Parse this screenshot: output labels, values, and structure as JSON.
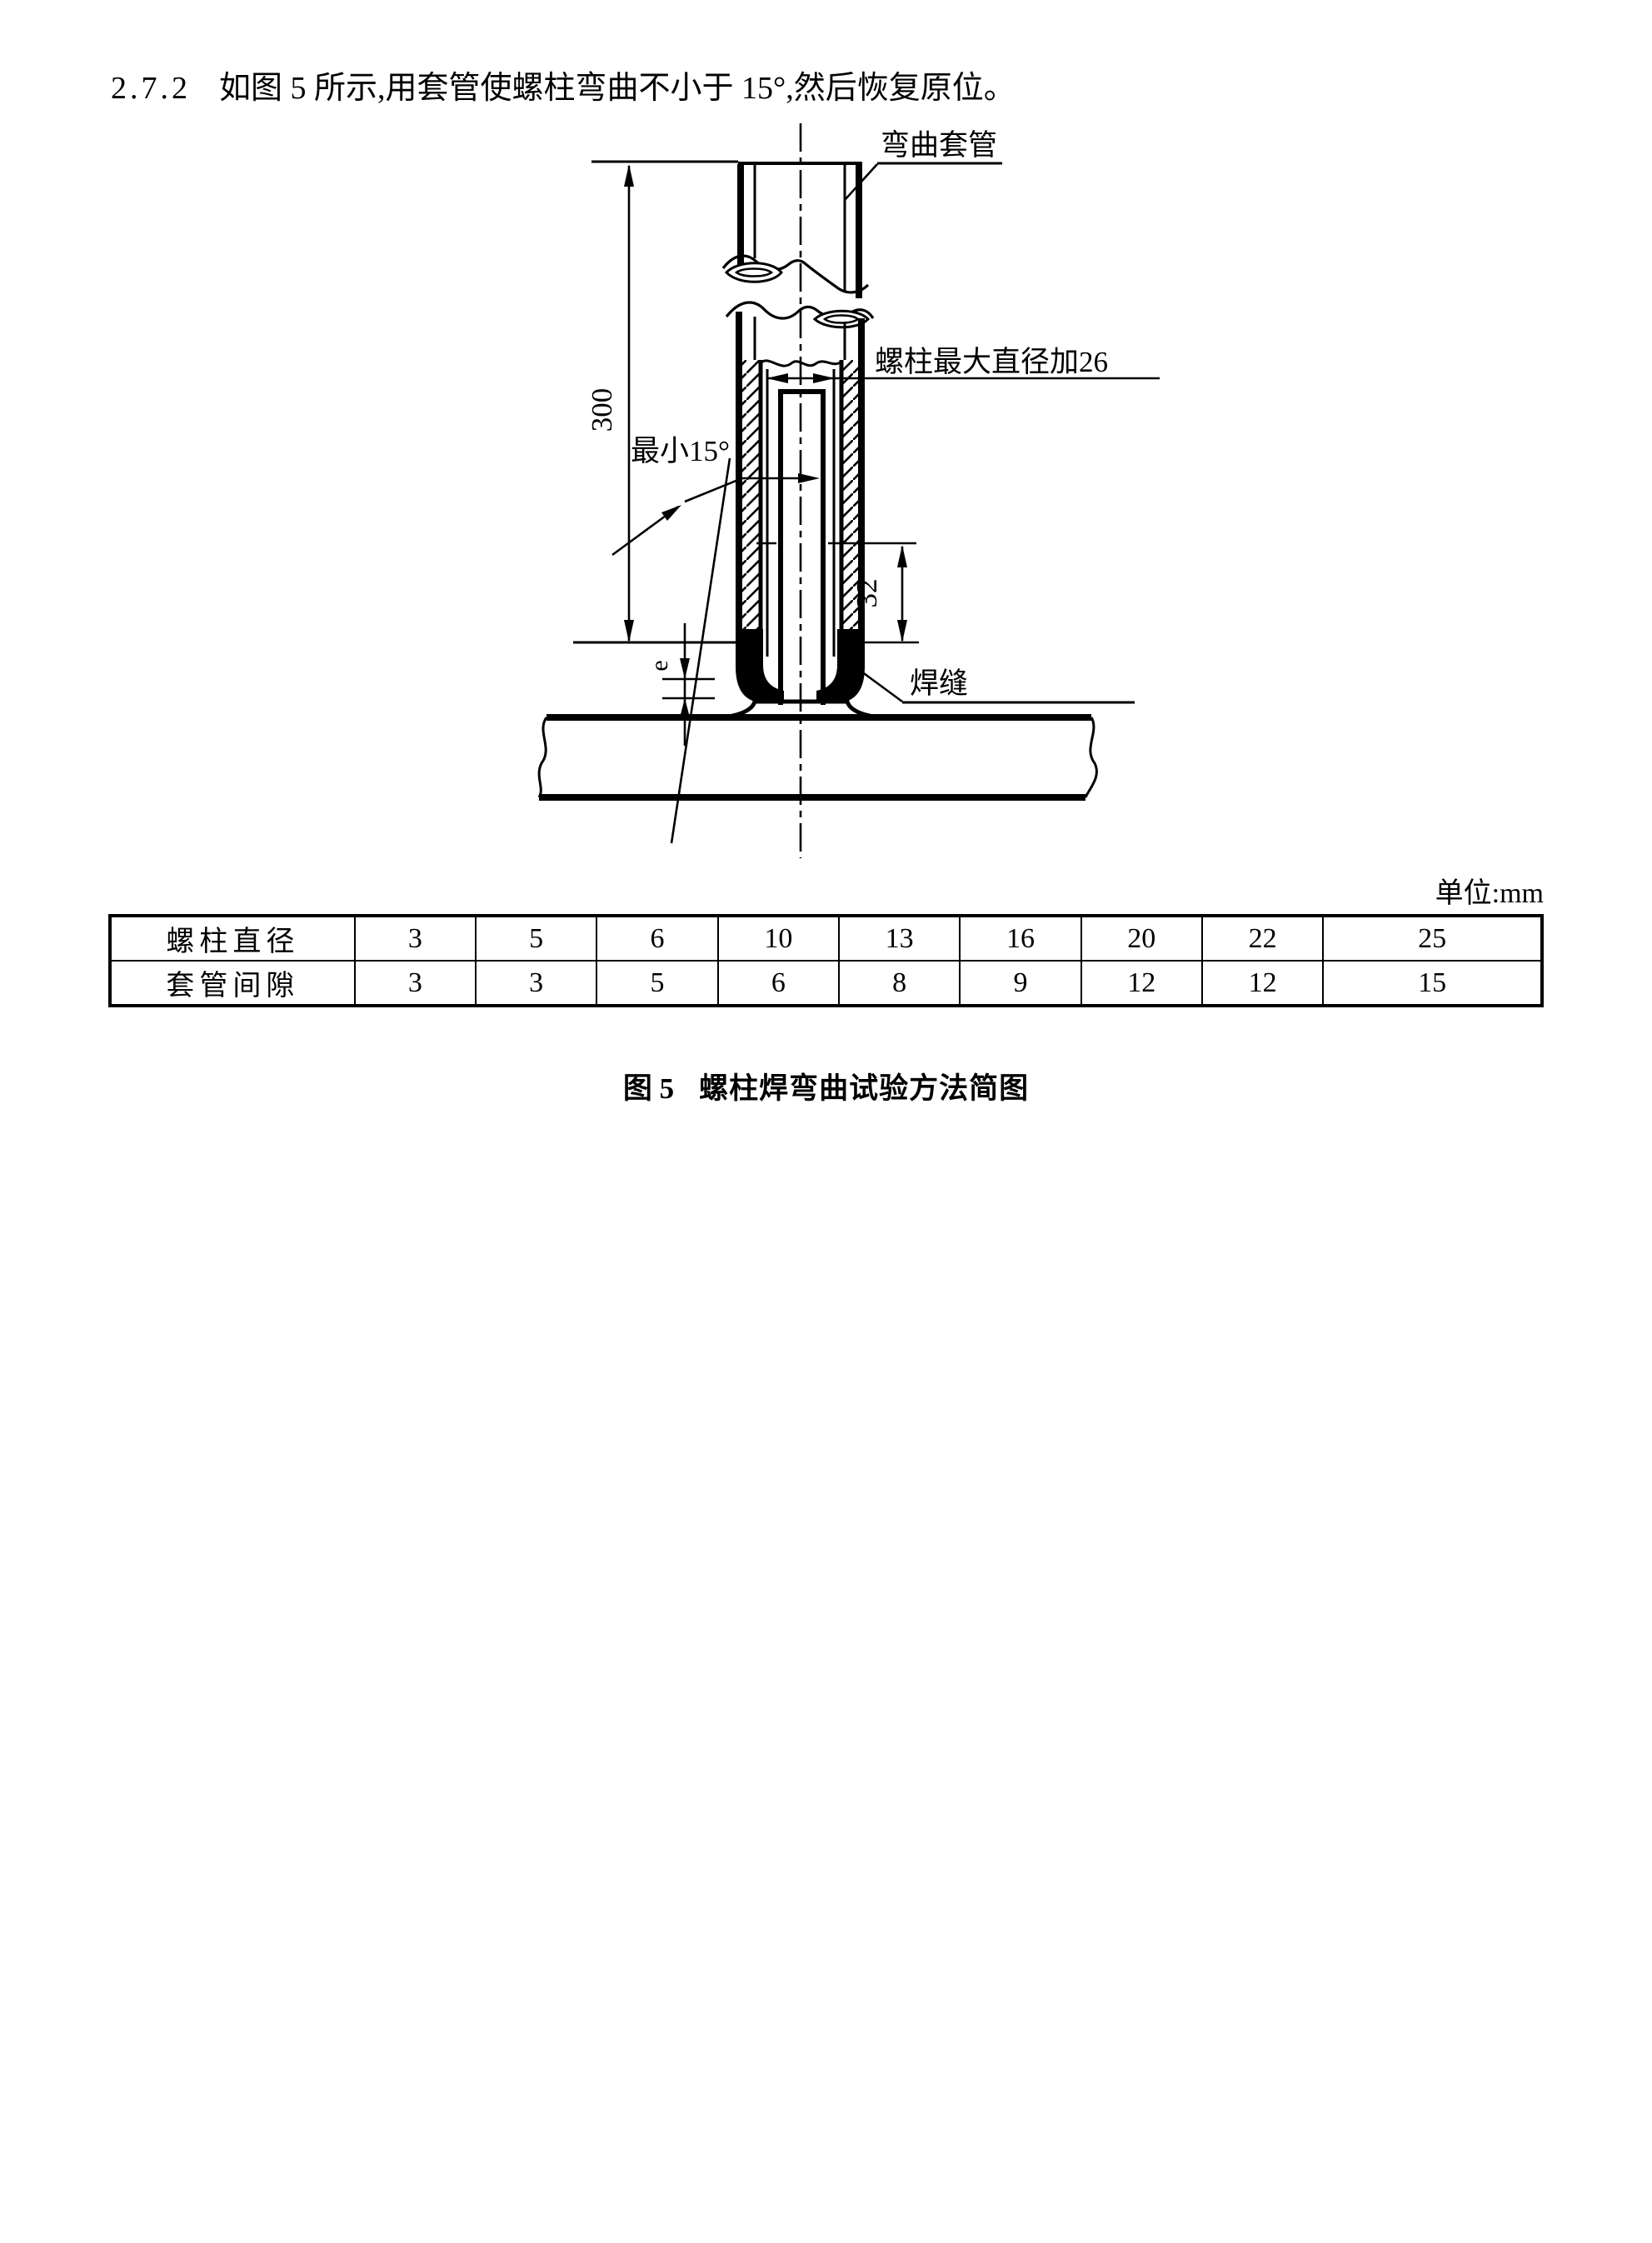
{
  "page": {
    "section_number": "2.7.2",
    "section_text": "如图 5 所示,用套管使螺柱弯曲不小于 15°,然后恢复原位。",
    "unit_label": "单位:mm",
    "caption_prefix": "图 5",
    "caption_text": "螺柱焊弯曲试验方法简图"
  },
  "diagram": {
    "labels": {
      "bend_sleeve": "弯曲套管",
      "bore_dia": "螺柱最大直径加26",
      "min_angle": "最小15°",
      "weld": "焊缝",
      "dim_length": "300",
      "dim_depth": "32",
      "dim_gap": "e"
    }
  },
  "table": {
    "rows": [
      {
        "label": "螺柱直径",
        "values": [
          "3",
          "5",
          "6",
          "10",
          "13",
          "16",
          "20",
          "22",
          "25"
        ]
      },
      {
        "label": "套管间隙",
        "values": [
          "3",
          "3",
          "5",
          "6",
          "8",
          "9",
          "12",
          "12",
          "15"
        ]
      }
    ]
  }
}
